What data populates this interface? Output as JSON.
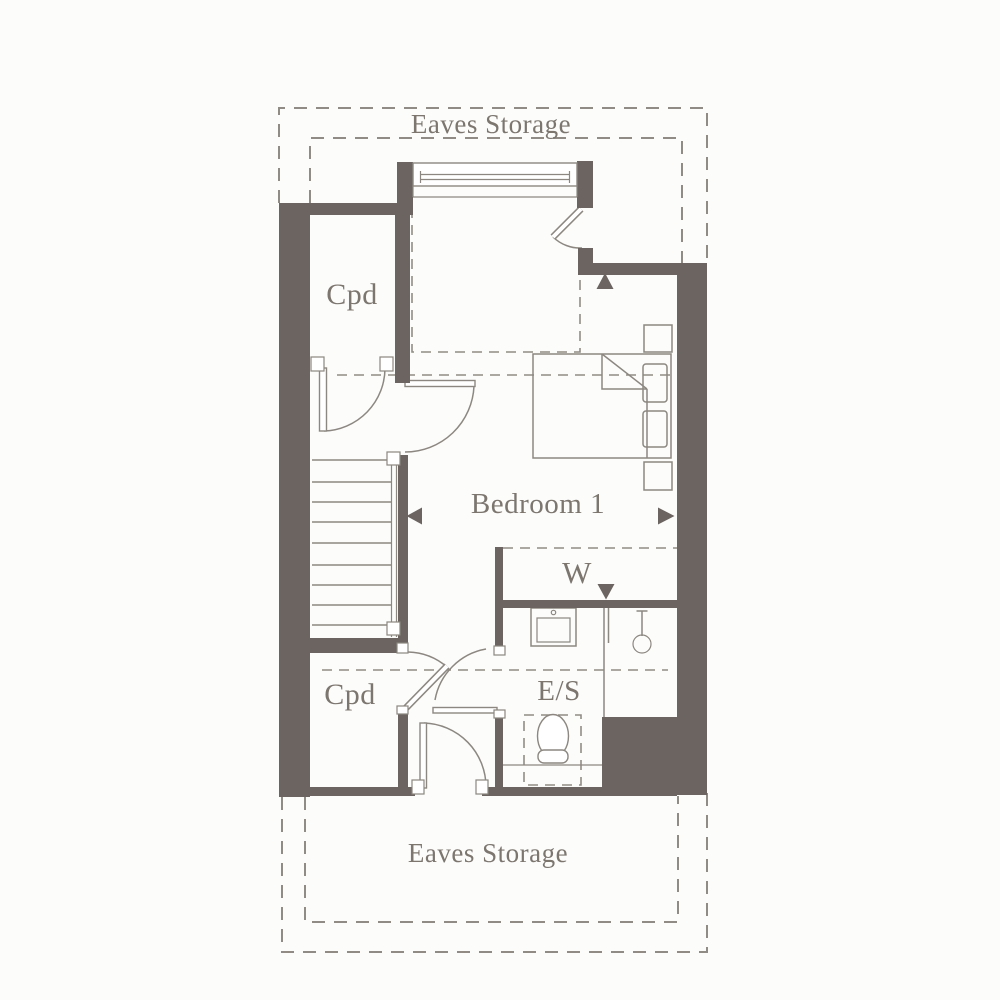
{
  "title": "First floor plan",
  "colors": {
    "wall": "#6b6460",
    "line": "#8c8780",
    "dashed": "#908b85",
    "text": "#7c766f",
    "background": "#fcfcfb"
  },
  "labels": {
    "eaves_storage_top": "Eaves Storage",
    "cupboard_top": "Cpd",
    "bedroom": "Bedroom 1",
    "wardrobe": "W",
    "cupboard_bottom": "Cpd",
    "ensuite": "E/S",
    "eaves_storage_bottom": "Eaves Storage"
  }
}
